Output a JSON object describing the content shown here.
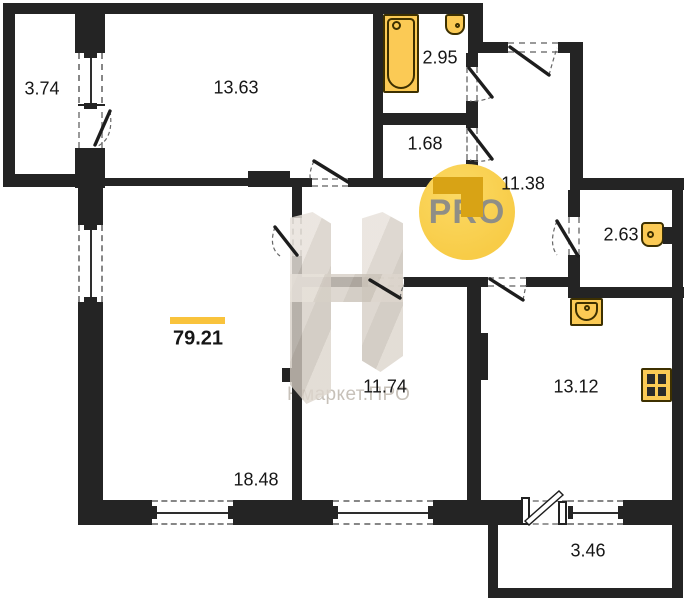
{
  "total": {
    "area": "79.21"
  },
  "rooms": {
    "balcony_top": {
      "area": "3.74"
    },
    "bedroom": {
      "area": "13.63"
    },
    "bathroom": {
      "area": "2.95"
    },
    "storage": {
      "area": "1.68"
    },
    "hallway": {
      "area": "11.38"
    },
    "wc": {
      "area": "2.63"
    },
    "living_room": {
      "area": "18.48"
    },
    "middle_room": {
      "area": "11.74"
    },
    "kitchen": {
      "area": "13.12"
    },
    "balcony_bottom": {
      "area": "3.46"
    }
  },
  "watermark": {
    "brand": "Нмаркет.ПРО",
    "pro": "PRO"
  },
  "icons": [
    "bathtub-icon",
    "sink-icon",
    "toilet-icon",
    "kitchen-sink-icon",
    "stove-icon"
  ],
  "colors": {
    "wall": "#242424",
    "fixture": "#fbca55",
    "fixture_border": "#3d3000",
    "accent": "#f9c33c",
    "pro_circle": "#f8cc47",
    "pro_text": "#8f8e86",
    "brand_text": "#c7c1b9",
    "watermark": "#d9d1c8"
  }
}
